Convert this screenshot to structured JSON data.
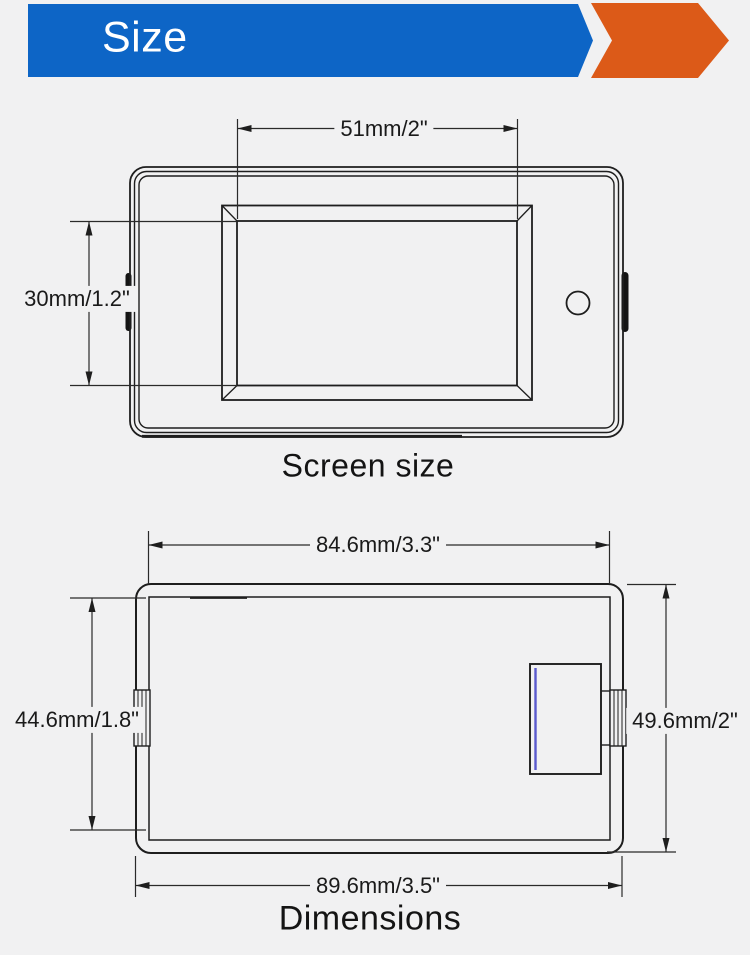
{
  "header": {
    "title": "Size",
    "banner_color": "#0d65c6",
    "chevron_color": "#dc5a18"
  },
  "screen_size_diagram": {
    "label": "Screen size",
    "width_dim": "51mm/2\"",
    "height_dim": "30mm/1.2\""
  },
  "dimensions_diagram": {
    "label": "Dimensions",
    "top_dim": "84.6mm/3.3\"",
    "left_dim": "44.6mm/1.8\"",
    "right_dim": "49.6mm/2\"",
    "bottom_dim": "89.6mm/3.5\"",
    "accent_line_color": "#5a5ace"
  }
}
